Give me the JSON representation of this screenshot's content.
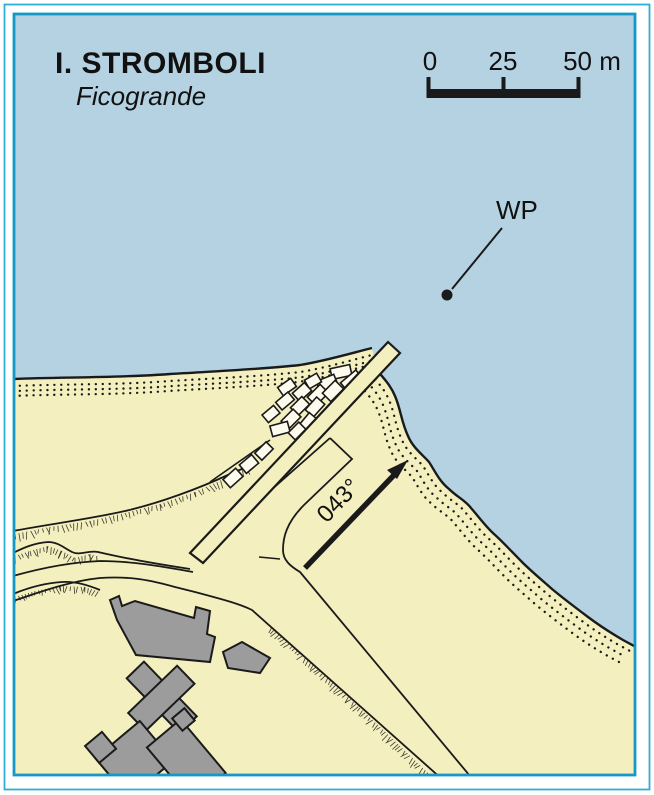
{
  "map": {
    "island_title": "I. STROMBOLI",
    "place_subtitle": "Ficogrande",
    "waypoint": {
      "label": "WP"
    },
    "approach_bearing": {
      "label": "043°"
    },
    "scale_bar": {
      "labels": [
        "0",
        "25",
        "50 m"
      ]
    },
    "colors": {
      "sea": "#b4d2e2",
      "land": "#f4efbe",
      "building": "#9c9c9c",
      "frame_outer": "#2fadd9",
      "frame_inner": "#1398c8",
      "ink": "#1a1a1a"
    }
  }
}
